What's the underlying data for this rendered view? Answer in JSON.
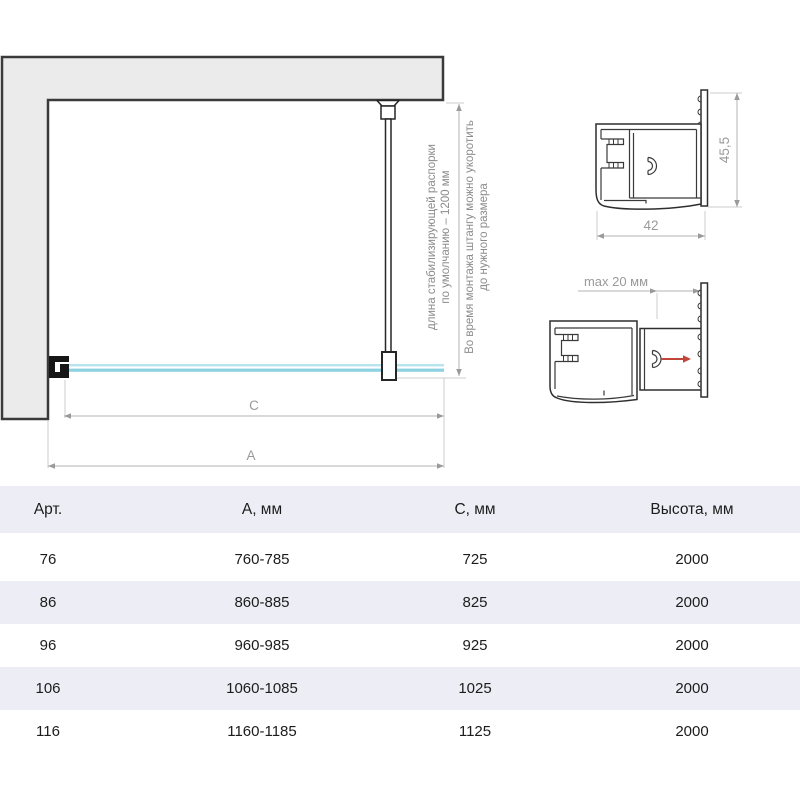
{
  "diagram": {
    "note_default": {
      "line1": "длина стабилизирующей распорки",
      "line2": "по умолчанию – 1200 мм"
    },
    "note_install": {
      "line1": "Во время монтажа штангу можно укоротить",
      "line2": "до нужного размера"
    },
    "dim_c": "C",
    "dim_a": "A"
  },
  "profiles": {
    "height_label": "45,5",
    "width_label": "42",
    "max_label": "max 20 мм"
  },
  "colors": {
    "wall": "#ebebeb",
    "glass": "#8ed2e2",
    "glass_light": "#b7e4ee",
    "red_arrow": "#c2453a",
    "row_alt": "#edeef5"
  },
  "table": {
    "headers": [
      "Арт.",
      "А, мм",
      "С, мм",
      "Высота, мм"
    ],
    "rows": [
      [
        "76",
        "760-785",
        "725",
        "2000"
      ],
      [
        "86",
        "860-885",
        "825",
        "2000"
      ],
      [
        "96",
        "960-985",
        "925",
        "2000"
      ],
      [
        "106",
        "1060-1085",
        "1025",
        "2000"
      ],
      [
        "116",
        "1160-1185",
        "1125",
        "2000"
      ]
    ]
  }
}
